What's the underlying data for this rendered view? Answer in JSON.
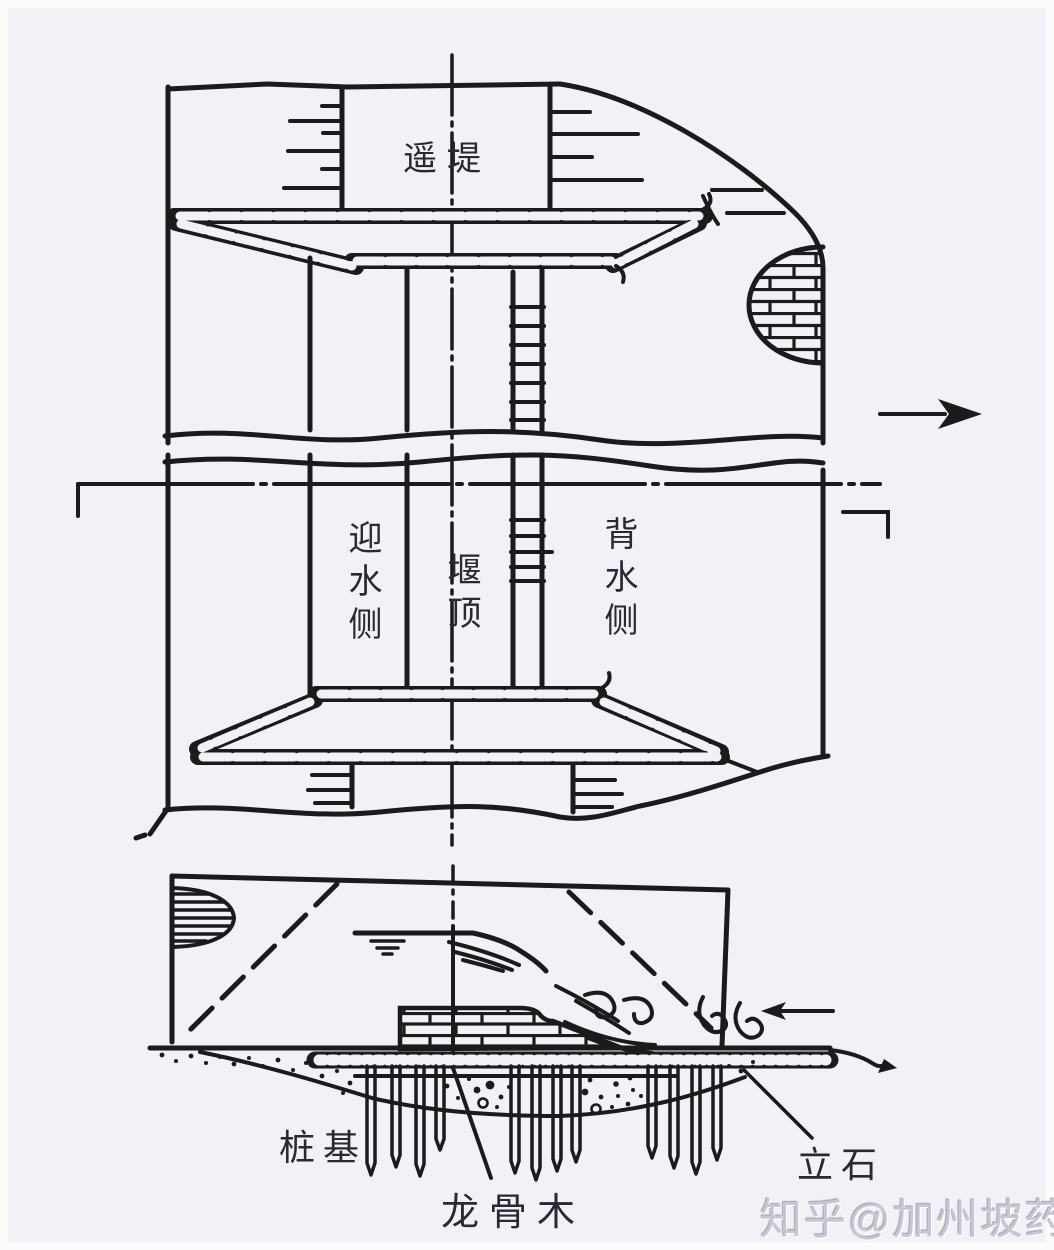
{
  "figure": {
    "type": "engineering-diagram",
    "subject": "Ancient Chinese overflow weir (plan view above, cross-section below)"
  },
  "labels": {
    "top_dike": "遥堤",
    "upstream_side": "迎水侧",
    "weir_crest": "堰顶",
    "downstream_side": "背水侧",
    "pile_foundation": "桩基",
    "keel_wood": "龙骨木",
    "standing_stone": "立石"
  },
  "watermark": {
    "text": "知乎@加州坡药书房"
  },
  "icons": {
    "flow_direction_arrow": "arrow-right (river flow direction)",
    "tailwater_arrow": "arrow-left (backflow at weir toe)",
    "water_surface": "water level symbol"
  },
  "colors": {
    "ink": "#1b1b1d",
    "paper": "#f1f2f5",
    "label_ink": "#2c2733",
    "watermark": "#c9c6d3"
  }
}
